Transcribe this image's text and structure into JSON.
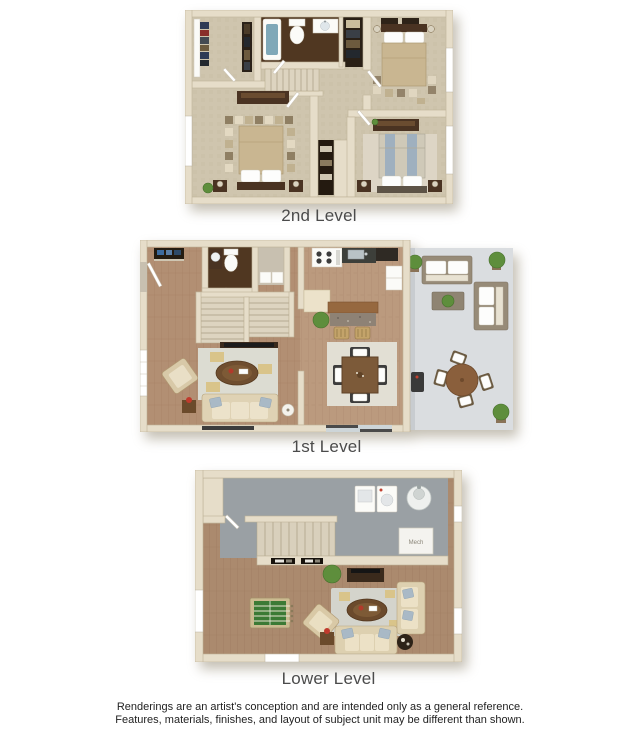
{
  "page": {
    "background": "#ffffff"
  },
  "plans": [
    {
      "id": "second-level",
      "label": "2nd Level"
    },
    {
      "id": "first-level",
      "label": "1st Level"
    },
    {
      "id": "lower-level",
      "label": "Lower Level"
    }
  ],
  "lower_level": {
    "mech_label": "Mech"
  },
  "disclaimer": {
    "line1": "Renderings are an artist's conception and are intended only as a general reference.",
    "line2": "Features, materials, finishes, and layout of subject unit may be different than shown."
  },
  "colors": {
    "wall": "#e6ddc9",
    "carpet": "#cfc5ae",
    "wood_floor": "#b28f73",
    "bath_floor": "#503721",
    "utility_floor": "#9aa0a4",
    "patio_concrete": "#dadde0",
    "rug": "#dcdcd2",
    "label_text": "#4b4b4b",
    "disclaimer_text": "#1f1f1f"
  }
}
